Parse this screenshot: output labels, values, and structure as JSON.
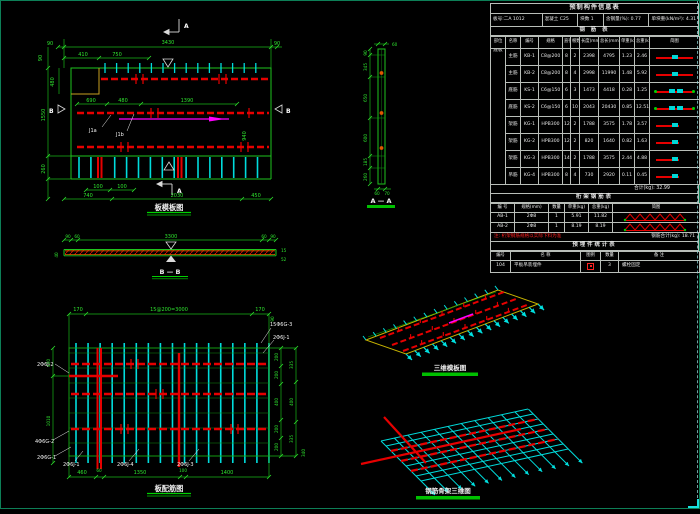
{
  "titles": {
    "plan": "板模板图",
    "bb": "B — B",
    "aa": "A — A",
    "rebar": "板配筋图",
    "iso1": "三维模板图",
    "iso2": "钢筋骨架三维图"
  },
  "plan": {
    "marks": {
      "a": "A",
      "b": "B"
    },
    "labels": {
      "j1": "J1a",
      "j2": "J1b"
    },
    "dims": {
      "t90l": "90",
      "t3430": "3430",
      "t90r": "90",
      "t410": "410",
      "t750": "750",
      "l90": "90",
      "l480": "480",
      "l1550": "1550",
      "l260": "260",
      "m690": "690",
      "m480": "480",
      "m1390": "1390",
      "d940": "940",
      "b100a": "100",
      "b100b": "100",
      "b740": "740",
      "b2030": "2030",
      "b450": "450"
    }
  },
  "bb": {
    "dims": {
      "l90": "90",
      "l60": "60",
      "c3300": "3300",
      "r60": "60",
      "r90": "90",
      "h40": "40",
      "r15": "15",
      "r52": "52"
    }
  },
  "aa": {
    "dims": {
      "t60": "60",
      "chain": [
        "90",
        "345",
        "650",
        "600",
        "185",
        "260"
      ],
      "b60": "60",
      "b70": "70"
    }
  },
  "rebar": {
    "dims": {
      "t170a": "170",
      "t3000": "15@200=3000",
      "t170b": "170",
      "t90": "90",
      "l400": "400",
      "l1010": "1010",
      "rin": [
        "200",
        "200",
        "400",
        "200",
        "200"
      ],
      "rout": [
        "335",
        "400",
        "335"
      ],
      "b340": "340",
      "b": [
        "460",
        "60",
        "1350",
        "100",
        "1400"
      ]
    },
    "labels": {
      "j2": "2Φ6J-2",
      "g2": "4Φ6G-2",
      "g1": "2Φ6G-1",
      "bj1": "2Φ6J-1",
      "bj4": "2Φ6J-4",
      "bj3": "2Φ6J-3",
      "tg3": "15Φ6G-3",
      "tj1": "2Φ6J-1"
    }
  },
  "table": {
    "title": "预制构件信息表",
    "info": [
      "板号:二A 1012",
      "混凝土 C25",
      "块数 1",
      "含钢量(%): 0.77",
      "单块重(kN/m²): 4.31"
    ],
    "sec_rebar": "钢 筋 表",
    "headers": [
      "部位",
      "名称",
      "编号",
      "规格",
      "直径",
      "根数",
      "长度(mm)",
      "总长(mm)",
      "单重(kg)",
      "总重(kg)",
      "简图"
    ],
    "group": "底板",
    "rows": [
      {
        "name": "主筋",
        "no": "KB-1",
        "spec": "C8@200",
        "dia": "8",
        "n": "2",
        "len": "2398",
        "total": "4795",
        "uw": "1.23",
        "tw": "2.46",
        "sk": "long"
      },
      {
        "name": "主筋",
        "no": "KB-2",
        "spec": "C8@200",
        "dia": "8",
        "n": "4",
        "len": "2998",
        "total": "11990",
        "uw": "1.48",
        "tw": "5.92",
        "sk": "long"
      },
      {
        "name": "底筋",
        "no": "KS-1",
        "spec": "C6@150",
        "dia": "6",
        "n": "3",
        "len": "1473",
        "total": "4418",
        "uw": "0.28",
        "tw": "1.25",
        "sk": "dots"
      },
      {
        "name": "底筋",
        "no": "KS-2",
        "spec": "C6@150",
        "dia": "6",
        "n": "10",
        "len": "2043",
        "total": "20430",
        "uw": "0.85",
        "tw": "12.51",
        "sk": "dots"
      },
      {
        "name": "架筋",
        "no": "KG-1",
        "spec": "HPB300",
        "dia": "12",
        "n": "2",
        "len": "1788",
        "total": "3575",
        "uw": "1.78",
        "tw": "3.57",
        "sk": "short"
      },
      {
        "name": "架筋",
        "no": "KG-2",
        "spec": "HPB300",
        "dia": "12",
        "n": "2",
        "len": "820",
        "total": "1640",
        "uw": "0.82",
        "tw": "1.63",
        "sk": "short"
      },
      {
        "name": "架筋",
        "no": "KG-3",
        "spec": "HPB300",
        "dia": "14",
        "n": "2",
        "len": "1788",
        "total": "3575",
        "uw": "2.44",
        "tw": "4.88",
        "sk": "short"
      },
      {
        "name": "吊筋",
        "no": "KG-4",
        "spec": "HPB300",
        "dia": "8",
        "n": "4",
        "len": "730",
        "total": "2920",
        "uw": "0.11",
        "tw": "0.45",
        "sk": "short"
      }
    ],
    "sum": "合计(kg): 32.99",
    "sec_truss": "桁架钢筋表",
    "truss_headers": [
      "编 号",
      "规格(mm)",
      "数量",
      "单重(kg)",
      "总重(kg)",
      "简图"
    ],
    "truss_rows": [
      {
        "no": "AB-1",
        "spec": "2Φ8",
        "n": "1",
        "uw": "5.91",
        "tw": "11.82"
      },
      {
        "no": "AB-2",
        "spec": "2Φ8",
        "n": "1",
        "uw": "8.19",
        "tw": "8.19"
      }
    ],
    "note": "注: 桁架钢筋规格以实际下料为准",
    "sum2": "钢筋合计(kg): 18.71",
    "sec_embed": "预埋件统计表",
    "embed_headers": [
      "编号",
      "名 称",
      "图例",
      "数量",
      "备 注"
    ],
    "embed_row": {
      "no": "104",
      "name": "平板吊装埋件",
      "n": "3",
      "note": "螺栓固定"
    }
  }
}
